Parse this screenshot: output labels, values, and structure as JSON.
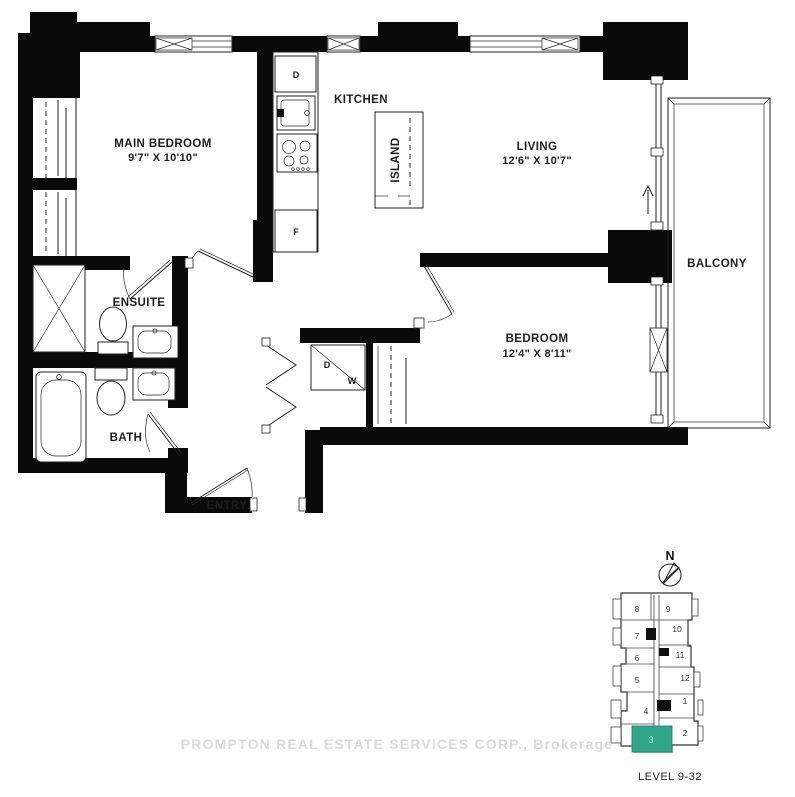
{
  "floorplan": {
    "rooms": {
      "main_bedroom": {
        "label": "MAIN BEDROOM",
        "dims": "9'7\" X 10'10\""
      },
      "kitchen": {
        "label": "KITCHEN"
      },
      "island": {
        "label": "ISLAND"
      },
      "living": {
        "label": "LIVING",
        "dims": "12'6\" X 10'7\""
      },
      "bedroom": {
        "label": "BEDROOM",
        "dims": "12'4\" X 8'11\""
      },
      "balcony": {
        "label": "BALCONY"
      },
      "ensuite": {
        "label": "ENSUITE"
      },
      "bath": {
        "label": "BATH"
      },
      "entry": {
        "label": "ENTRY"
      }
    },
    "appliances": {
      "dishwasher": "D",
      "fridge": "F",
      "dryer": "D",
      "washer": "W"
    }
  },
  "keyplan": {
    "north": "N",
    "level": "LEVEL 9-32",
    "highlighted_unit": "3",
    "colors": {
      "highlight": "#2ea687"
    },
    "units": {
      "u1": "1",
      "u2": "2",
      "u3": "3",
      "u4": "4",
      "u5": "5",
      "u6": "6",
      "u7": "7",
      "u8": "8",
      "u9": "9",
      "u10": "10",
      "u11": "11",
      "u12": "12"
    }
  },
  "watermark": "PROMPTON REAL ESTATE SERVICES CORP., Brokerage"
}
